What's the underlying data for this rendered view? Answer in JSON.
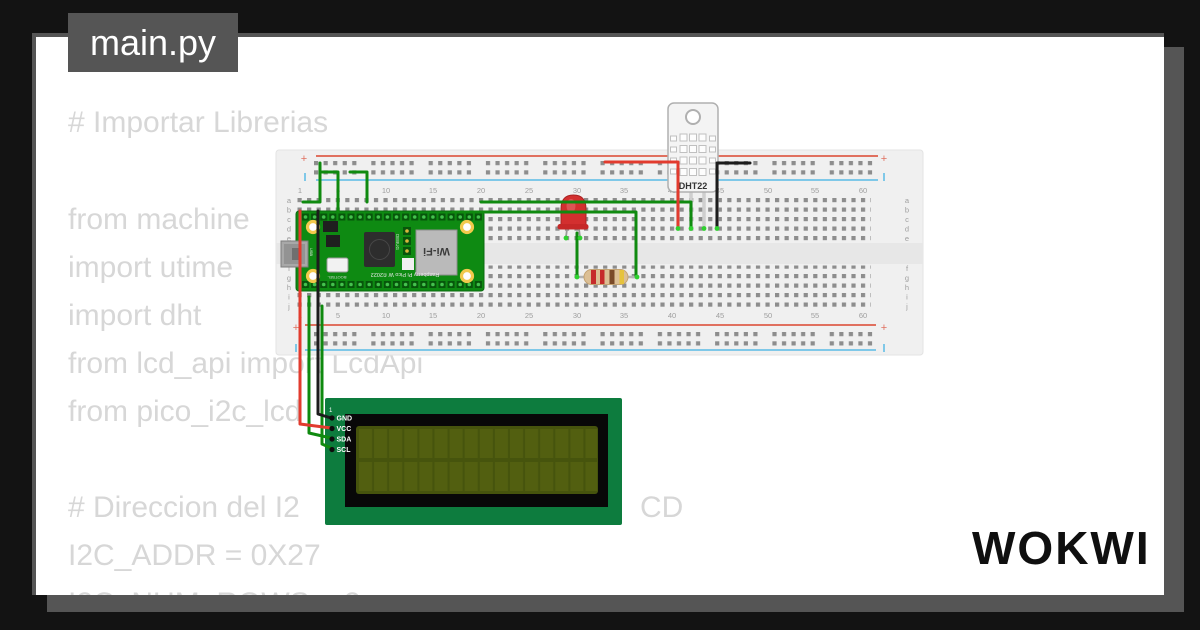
{
  "tab": {
    "label": "main.py"
  },
  "code": {
    "lines": [
      "# Importar Librerias",
      "from machine",
      "import utime",
      "import dht",
      "from lcd_api import LcdApi",
      "from pico_i2c_lcd",
      "# Direccion del I2",
      "I2C_ADDR = 0X27",
      "I2C_NUM_ROWS = 2"
    ],
    "occluded_fragment": "CD"
  },
  "breadboard": {
    "column_numbers": [
      "1",
      "5",
      "10",
      "15",
      "20",
      "25",
      "30",
      "35",
      "40",
      "45",
      "50",
      "55",
      "60"
    ],
    "rows_top": [
      "a",
      "b",
      "c",
      "d",
      "e"
    ],
    "rows_bottom": [
      "f",
      "g",
      "h",
      "i",
      "j"
    ],
    "plus": "+"
  },
  "pico": {
    "board_label": "Raspberry Pi Pico W ©2022",
    "wifi_label": "Wi-Fi",
    "debug_label": "DEBUG",
    "bootsel_label": "BOOTSEL",
    "usb_label": "USB"
  },
  "dht22": {
    "label": "DHT22"
  },
  "lcd": {
    "pin_number": "1",
    "pin_labels": [
      "GND",
      "VCC",
      "SDA",
      "SCL"
    ]
  },
  "logo": {
    "text": "WOKWI"
  },
  "colors": {
    "background": "#131313",
    "panel_gray": "#555555",
    "code_text": "#d7d7d7",
    "wire_green": "#0f8a0f",
    "wire_red": "#e23b2e",
    "wire_black": "#1c1c1c",
    "pico_green": "#0e8a12",
    "lcd_green": "#0d7c3e",
    "lcd_screen": "#46540d",
    "breadboard": "#f0f0f0",
    "rail_red": "#e0705f",
    "rail_blue": "#7fc8e8"
  }
}
